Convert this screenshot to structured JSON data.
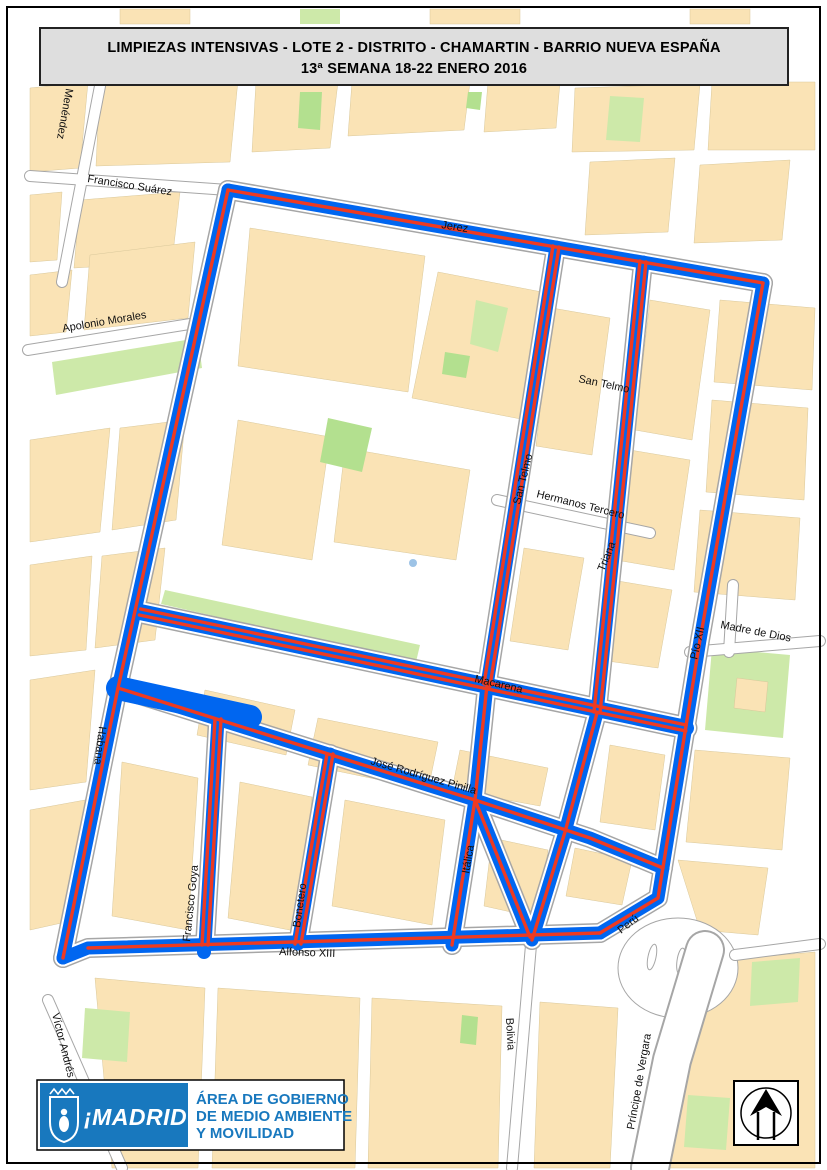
{
  "title": {
    "line1": "LIMPIEZAS  INTENSIVAS - LOTE 2 - DISTRITO - CHAMARTIN - BARRIO NUEVA ESPAÑA",
    "line2": "13ª SEMANA 18-22 ENERO 2016"
  },
  "map": {
    "street_labels": [
      {
        "text": "Menéndez"
      },
      {
        "text": "Francisco Suárez"
      },
      {
        "text": "Jerez"
      },
      {
        "text": "Apolonio Morales"
      },
      {
        "text": "San Telmo"
      },
      {
        "text": "San Telmo"
      },
      {
        "text": "Hermanos Tercero"
      },
      {
        "text": "Triana"
      },
      {
        "text": "Madre de Dios"
      },
      {
        "text": "Pío XII"
      },
      {
        "text": "Macarena"
      },
      {
        "text": "José Rodríguez Pinilla"
      },
      {
        "text": "Habana"
      },
      {
        "text": "Itálica"
      },
      {
        "text": "Francisco Goya"
      },
      {
        "text": "Bonetero"
      },
      {
        "text": "Alfonso XIII"
      },
      {
        "text": "Perú"
      },
      {
        "text": "Bolivia"
      },
      {
        "text": "Príncipe de Vergara"
      },
      {
        "text": "Víctor Andrés"
      }
    ],
    "colors": {
      "route_blue": "#0066F0",
      "route_red": "#EE3A21",
      "building": "#FAE3B5",
      "park_green": "#CDE9A9",
      "logo_blue": "#1878BE"
    }
  },
  "footer": {
    "madrid_logo_text": "¡MADRID!",
    "department": [
      "ÁREA DE GOBIERNO",
      "DE MEDIO AMBIENTE",
      "Y MOVILIDAD"
    ]
  },
  "compass": {
    "description": "north-arrow"
  }
}
